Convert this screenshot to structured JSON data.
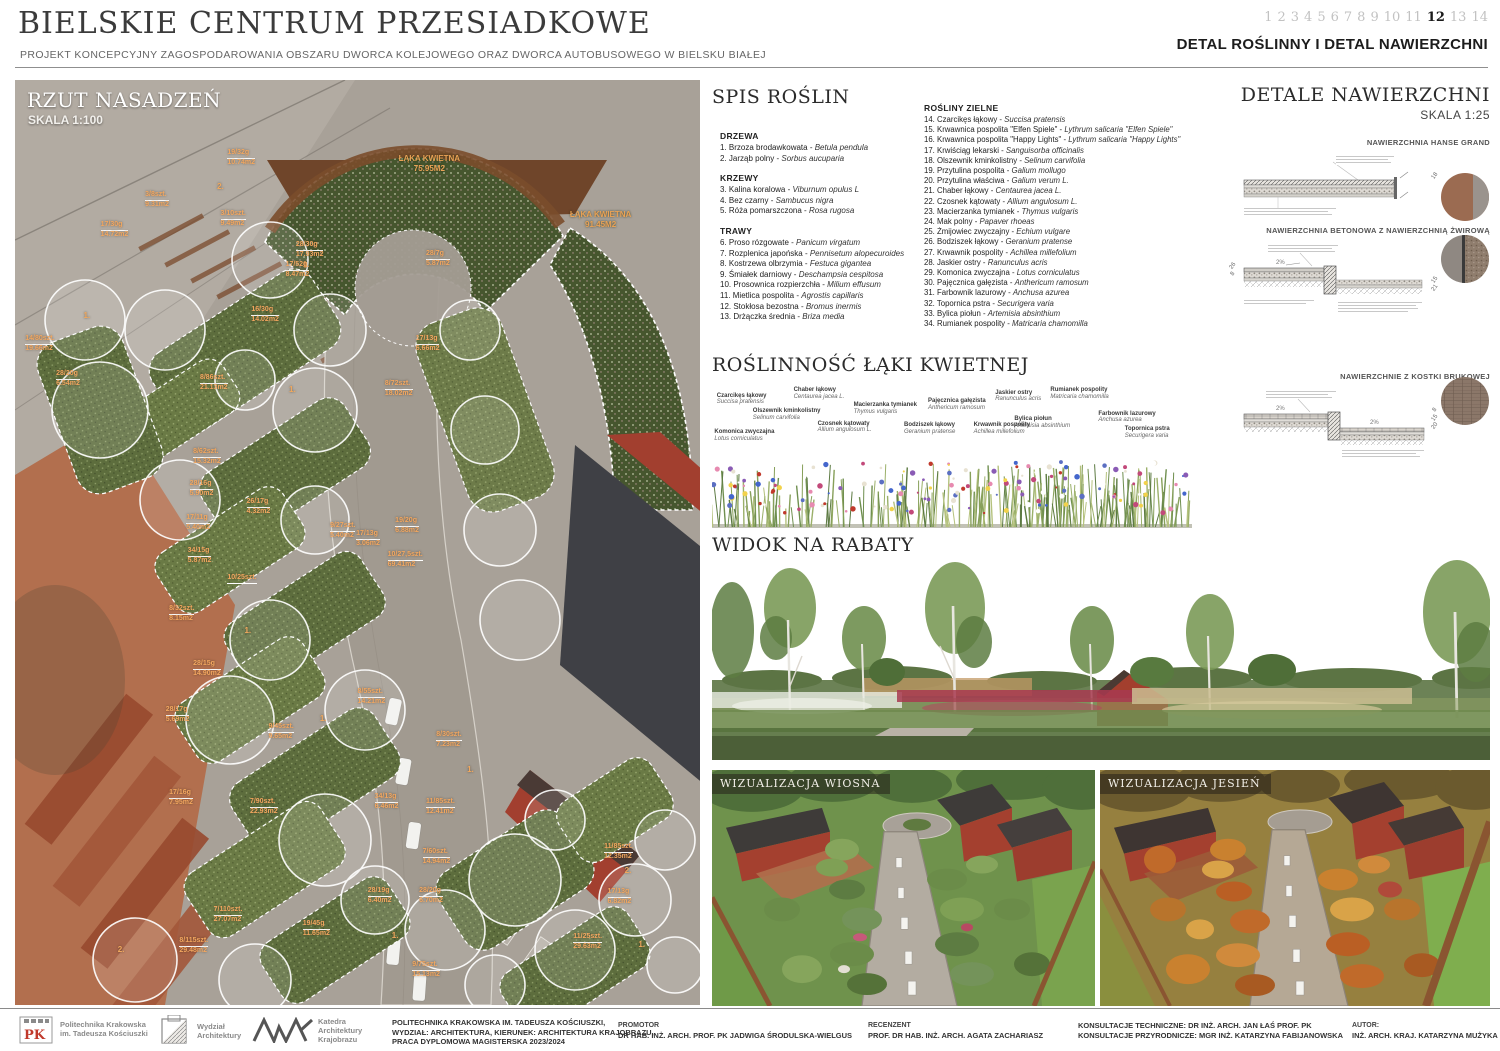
{
  "header": {
    "title": "BIELSKIE CENTRUM PRZESIADKOWE",
    "subtitle": "PROJEKT KONCEPCYJNY ZAGOSPODAROWANIA OBSZARU DWORCA KOLEJOWEGO ORAZ DWORCA AUTOBUSOWEGO W BIELSKU BIAŁEJ",
    "pages": [
      "1",
      "2",
      "3",
      "4",
      "5",
      "6",
      "7",
      "8",
      "9",
      "10",
      "11",
      "12",
      "13",
      "14"
    ],
    "current_page": "12",
    "sheet_title": "DETAL ROŚLINNY I DETAL NAWIERZCHNI"
  },
  "plan": {
    "title": "RZUT NASADZEŃ",
    "scale": "SKALA 1:100",
    "meadow_areas": [
      {
        "name": "ŁĄKA KWIETNA",
        "area": "75.95M2",
        "x": "56%",
        "y": "8%"
      },
      {
        "name": "ŁĄKA KWIETNA",
        "area": "91.45M2",
        "x": "81%",
        "y": "14%"
      }
    ],
    "tree_tags": [
      {
        "n": "1.",
        "x": "10%",
        "y": "25%"
      },
      {
        "n": "2.",
        "x": "29.5%",
        "y": "11%"
      },
      {
        "n": "1.",
        "x": "42%",
        "y": "19.5%"
      },
      {
        "n": "1.",
        "x": "40%",
        "y": "33%"
      },
      {
        "n": "1.",
        "x": "33.5%",
        "y": "59%"
      },
      {
        "n": "1.",
        "x": "44.5%",
        "y": "68.5%"
      },
      {
        "n": "1.",
        "x": "66%",
        "y": "74%"
      },
      {
        "n": "2.",
        "x": "15%",
        "y": "93.5%"
      },
      {
        "n": "1.",
        "x": "55%",
        "y": "92%"
      },
      {
        "n": "2.",
        "x": "89%",
        "y": "85%"
      },
      {
        "n": "1.",
        "x": "91%",
        "y": "93%"
      }
    ],
    "annotations": [
      {
        "code": "19/32g",
        "area": "10.74m2",
        "x": "31%",
        "y": "7.5%"
      },
      {
        "code": "3/8szt.",
        "area": "9.31m2",
        "x": "19%",
        "y": "12%"
      },
      {
        "code": "3/10szt.",
        "area": "9.49m2",
        "x": "30%",
        "y": "14%"
      },
      {
        "code": "17/30g",
        "area": "14.72m2",
        "x": "12.5%",
        "y": "15.2%"
      },
      {
        "code": "28/30g",
        "area": "17.93m2",
        "x": "41%",
        "y": "17.4%"
      },
      {
        "code": "17/52g",
        "area": "8.47m2",
        "x": "39.5%",
        "y": "19.6%"
      },
      {
        "code": "28/7g",
        "area": "5.87m2",
        "x": "60%",
        "y": "18.4%"
      },
      {
        "code": "16/30g",
        "area": "14.02m2",
        "x": "34.5%",
        "y": "24.4%"
      },
      {
        "code": "14/80szt.",
        "area": "19.66m2",
        "x": "1.5%",
        "y": "27.6%"
      },
      {
        "code": "17/13g",
        "area": "6.66m2",
        "x": "58.5%",
        "y": "27.6%"
      },
      {
        "code": "8/86szt.",
        "area": "21.13m2",
        "x": "27%",
        "y": "31.8%"
      },
      {
        "code": "8/72szt.",
        "area": "18.02m2",
        "x": "54%",
        "y": "32.4%"
      },
      {
        "code": "28/20g",
        "area": "6.54m2",
        "x": "6%",
        "y": "31.4%"
      },
      {
        "code": "8/62szt.",
        "area": "15.32m2",
        "x": "26%",
        "y": "39.8%"
      },
      {
        "code": "28/16g",
        "area": "5.90m2",
        "x": "25.5%",
        "y": "43.2%"
      },
      {
        "code": "26/17g",
        "area": "4.32m2",
        "x": "33.8%",
        "y": "45.2%"
      },
      {
        "code": "17/11g",
        "area": "5.40m2",
        "x": "25%",
        "y": "46.9%"
      },
      {
        "code": "9/27szt.",
        "area": "5.40m2",
        "x": "46%",
        "y": "47.8%"
      },
      {
        "code": "19/20g",
        "area": "6.88m2",
        "x": "55.5%",
        "y": "47.2%"
      },
      {
        "code": "17/13g",
        "area": "3.06m2",
        "x": "49.8%",
        "y": "48.7%"
      },
      {
        "code": "34/15g",
        "area": "5.87m2",
        "x": "25.2%",
        "y": "50.5%"
      },
      {
        "code": "10/27,5szt.",
        "area": "69.41m2",
        "x": "54.4%",
        "y": "50.9%"
      },
      {
        "code": "10/25szt.",
        "area": "",
        "x": "31%",
        "y": "53.4%"
      },
      {
        "code": "8/32szt.",
        "area": "8.15m2",
        "x": "22.5%",
        "y": "56.8%"
      },
      {
        "code": "28/15g",
        "area": "14.90m2",
        "x": "26%",
        "y": "62.7%"
      },
      {
        "code": "8/55szt.",
        "area": "14.21m2",
        "x": "50%",
        "y": "65.7%"
      },
      {
        "code": "28/17g",
        "area": "5.69m2",
        "x": "22%",
        "y": "67.7%"
      },
      {
        "code": "9/45szt.",
        "area": "9.65m2",
        "x": "37%",
        "y": "69.5%"
      },
      {
        "code": "8/30szt.",
        "area": "7.23m2",
        "x": "61.5%",
        "y": "70.4%"
      },
      {
        "code": "17/16g",
        "area": "7.95m2",
        "x": "22.5%",
        "y": "76.6%"
      },
      {
        "code": "7/90szt.",
        "area": "22.93m2",
        "x": "34.3%",
        "y": "77.6%"
      },
      {
        "code": "34/13g",
        "area": "6.46m2",
        "x": "52.5%",
        "y": "77.1%"
      },
      {
        "code": "11/85szt.",
        "area": "12.41m2",
        "x": "60%",
        "y": "77.6%"
      },
      {
        "code": "7/60szt.",
        "area": "14.94m2",
        "x": "59.5%",
        "y": "83%"
      },
      {
        "code": "28/19g",
        "area": "6.40m2",
        "x": "51.5%",
        "y": "87.2%"
      },
      {
        "code": "28/20g",
        "area": "6.70m2",
        "x": "59%",
        "y": "87.2%"
      },
      {
        "code": "7/110szt.",
        "area": "27.07m2",
        "x": "29%",
        "y": "89.3%"
      },
      {
        "code": "19/45g",
        "area": "11.65m2",
        "x": "42%",
        "y": "90.8%"
      },
      {
        "code": "8/115szt.",
        "area": "29.48m2",
        "x": "24%",
        "y": "92.6%"
      },
      {
        "code": "11/85szt.",
        "area": "12.35m2",
        "x": "86%",
        "y": "82.5%"
      },
      {
        "code": "17/13g",
        "area": "6.82m2",
        "x": "86.5%",
        "y": "87.4%"
      },
      {
        "code": "11/25szt.",
        "area": "29.63m2",
        "x": "81.5%",
        "y": "92.2%"
      },
      {
        "code": "9/75szt.",
        "area": "15.13m2",
        "x": "58%",
        "y": "95.2%"
      }
    ]
  },
  "plant_list": {
    "title": "SPIS ROŚLIN",
    "drzewa_title": "DRZEWA",
    "drzewa": [
      {
        "pl": "1. Brzoza brodawkowata - ",
        "lat": "Betula pendula"
      },
      {
        "pl": "2. Jarząb polny - ",
        "lat": "Sorbus aucuparia"
      }
    ],
    "krzewy_title": "KRZEWY",
    "krzewy": [
      {
        "pl": "3. Kalina koralowa - ",
        "lat": "Viburnum opulus L"
      },
      {
        "pl": "4. Bez czarny - ",
        "lat": "Sambucus nigra"
      },
      {
        "pl": "5. Róża pomarszczona - ",
        "lat": "Rosa rugosa"
      }
    ],
    "trawy_title": "TRAWY",
    "trawy": [
      {
        "pl": "6. Proso rózgowate - ",
        "lat": "Panicum virgatum"
      },
      {
        "pl": "7. Rozplenica japońska - ",
        "lat": "Pennisetum alopecuroides"
      },
      {
        "pl": "8. Kostrzewa olbrzymia - ",
        "lat": "Festuca gigantea"
      },
      {
        "pl": "9. Śmiałek darniowy - ",
        "lat": "Deschampsia cespitosa"
      },
      {
        "pl": "10. Prosownica rozpierzchła - ",
        "lat": "Milium effusum"
      },
      {
        "pl": "11. Mietlica pospolita - ",
        "lat": "Agrostis capillaris"
      },
      {
        "pl": "12. Stokłosa bezostna - ",
        "lat": "Bromus inermis"
      },
      {
        "pl": "13. Drżączka średnia - ",
        "lat": "Briza media"
      }
    ],
    "zielne_title": "ROŚLINY ZIELNE",
    "zielne": [
      {
        "pl": "14. Czarcikęs łąkowy - ",
        "lat": "Succisa pratensis"
      },
      {
        "pl": "15. Krwawnica pospolita \"Elfen Spiele\" - ",
        "lat": "Lythrum salicaria \"Elfen Spiele\""
      },
      {
        "pl": "16. Krwawnica pospolita \"Happy Lights\" - ",
        "lat": "Lythrum salicaria \"Happy Lights\""
      },
      {
        "pl": "17. Krwiściąg lekarski - ",
        "lat": "Sanguisorba officinalis"
      },
      {
        "pl": "18. Olszewnik kminkolistny - ",
        "lat": "Selinum carvifolia"
      },
      {
        "pl": "19. Przytulina pospolita - ",
        "lat": "Galium mollugo"
      },
      {
        "pl": "20. Przytulina właściwa - ",
        "lat": "Galium verum L."
      },
      {
        "pl": "21. Chaber łąkowy - ",
        "lat": "Centaurea jacea L."
      },
      {
        "pl": "22. Czosnek kątowaty - ",
        "lat": "Allium angulosum L."
      },
      {
        "pl": "23. Macierzanka tymianek - ",
        "lat": "Thymus vulgaris"
      },
      {
        "pl": "24. Mak polny  - ",
        "lat": "Papaver rhoeas"
      },
      {
        "pl": "25. Żmijowiec zwyczajny - ",
        "lat": "Echium vulgare"
      },
      {
        "pl": "26. Bodziszek łąkowy - ",
        "lat": "Geranium pratense"
      },
      {
        "pl": "27. Krwawnik pospolity - ",
        "lat": "Achillea millefolium"
      },
      {
        "pl": "28. Jaskier ostry - ",
        "lat": "Ranunculus acris"
      },
      {
        "pl": "29. Komonica zwyczajna - ",
        "lat": "Lotus corniculatus"
      },
      {
        "pl": "30. Pajęcznica gałęzista - ",
        "lat": "Anthericum ramosum"
      },
      {
        "pl": "31. Farbownik lazurowy - ",
        "lat": "Anchusa azurea"
      },
      {
        "pl": "32. Topornica pstra - ",
        "lat": "Securigera varia"
      },
      {
        "pl": "33. Bylica piołun - ",
        "lat": "Artemisia absinthium"
      },
      {
        "pl": "34. Rumianek pospolity - ",
        "lat": "Matricaria chamomilla"
      }
    ]
  },
  "meadow": {
    "title": "ROŚLINNOŚĆ ŁĄKI KWIETNEJ",
    "labels": [
      {
        "pl": "Czarcikęs łąkowy",
        "lat": "Succisa pratensis",
        "x": "1%",
        "y": "18%"
      },
      {
        "pl": "Chaber łąkowy",
        "lat": "Centaurea jacea L.",
        "x": "17%",
        "y": "10%"
      },
      {
        "pl": "Jaskier ostry",
        "lat": "Ranunculus acris",
        "x": "59%",
        "y": "14%"
      },
      {
        "pl": "Rumianek pospolity",
        "lat": "Matricaria chamomilla",
        "x": "70.5%",
        "y": "10%"
      },
      {
        "pl": "Olszewnik kminkolistny",
        "lat": "Selinum carvifolia",
        "x": "8.5%",
        "y": "40%"
      },
      {
        "pl": "Macierzanka tymianek",
        "lat": "Thymus vulgaris",
        "x": "29.5%",
        "y": "32%"
      },
      {
        "pl": "Pajęcznica gałęzista",
        "lat": "Anthericum ramosum",
        "x": "45%",
        "y": "26%"
      },
      {
        "pl": "Bylica piołun",
        "lat": "Artemisia absinthium",
        "x": "63%",
        "y": "52%"
      },
      {
        "pl": "Farbownik lazurowy",
        "lat": "Anchusa azurea",
        "x": "80.5%",
        "y": "44%"
      },
      {
        "pl": "Komonica zwyczajna",
        "lat": "Lotus corniculatus",
        "x": "0.5%",
        "y": "70%"
      },
      {
        "pl": "Czosnek kątowaty",
        "lat": "Allium angulosum L.",
        "x": "22%",
        "y": "58%"
      },
      {
        "pl": "Bodziszek łąkowy",
        "lat": "Geranium pratense",
        "x": "40%",
        "y": "60%"
      },
      {
        "pl": "Krwawnik pospolity",
        "lat": "Achillea millefolium",
        "x": "54.5%",
        "y": "60%"
      },
      {
        "pl": "Topornica pstra",
        "lat": "Securigera varia",
        "x": "86%",
        "y": "66%"
      }
    ]
  },
  "rabaty": {
    "title": "WIDOK NA RABATY"
  },
  "details": {
    "title": "DETALE NAWIERZCHNI",
    "scale": "SKALA 1:25",
    "items": [
      {
        "label": "NAWIERZCHNIA HANSE GRAND"
      },
      {
        "label": "NAWIERZCHNIA BETONOWA Z NAWIERZCHNIĄ ŻWIROWĄ"
      },
      {
        "label": "NAWIERZCHNIE Z KOSTKI BRUKOWEJ"
      }
    ],
    "slope_label": "2%",
    "d1_dims": [
      "18"
    ],
    "d2_dims_left": [
      "26",
      "8"
    ],
    "d2_dims_right": [
      "15",
      "21"
    ],
    "d3_dims_right": [
      "8",
      "15",
      "20"
    ],
    "swatch_colors": {
      "hanse": "#9b6b51",
      "concrete": "#8f8882",
      "gravel": "#8f7d6d",
      "kostka": "#8b7769"
    }
  },
  "visualizations": [
    {
      "label": "WIZUALIZACJA WIOSNA"
    },
    {
      "label": "WIZUALIZACJA JESIEŃ"
    }
  ],
  "footer": {
    "logo_pk": "Politechnika Krakowska\nim. Tadeusza Kościuszki",
    "logo_wa": "Wydział\nArchitektury",
    "logo_kak": "Katedra\nArchitektury\nKrajobrazu",
    "university": "POLITECHNIKA KRAKOWSKA IM. TADEUSZA KOŚCIUSZKI,\nWYDZIAŁ: ARCHITEKTURA, KIERUNEK: ARCHITEKTURA KRAJOBRAZU,\nPRACA DYPLOMOWA MAGISTERSKA 2023/2024",
    "promotor_label": "PROMOTOR",
    "promotor": "DR HAB. INŻ. ARCH. PROF. PK JADWIGA ŚRODULSKA-WIELGUS",
    "recenzent_label": "RECENZENT",
    "recenzent": "PROF. DR HAB. INŻ. ARCH. AGATA ZACHARIASZ",
    "konsultacje_techniczne": "KONSULTACJE TECHNICZNE: DR INŻ. ARCH. JAN ŁAŚ PROF. PK",
    "konsultacje_przyrodnicze": "KONSULTACJE PRZYRODNICZE: MGR INŻ. KATARZYNA FABIJANOWSKA",
    "autor_label": "AUTOR:",
    "autor": "INŻ. ARCH. KRAJ. KATARZYNA MUŻYKA"
  }
}
